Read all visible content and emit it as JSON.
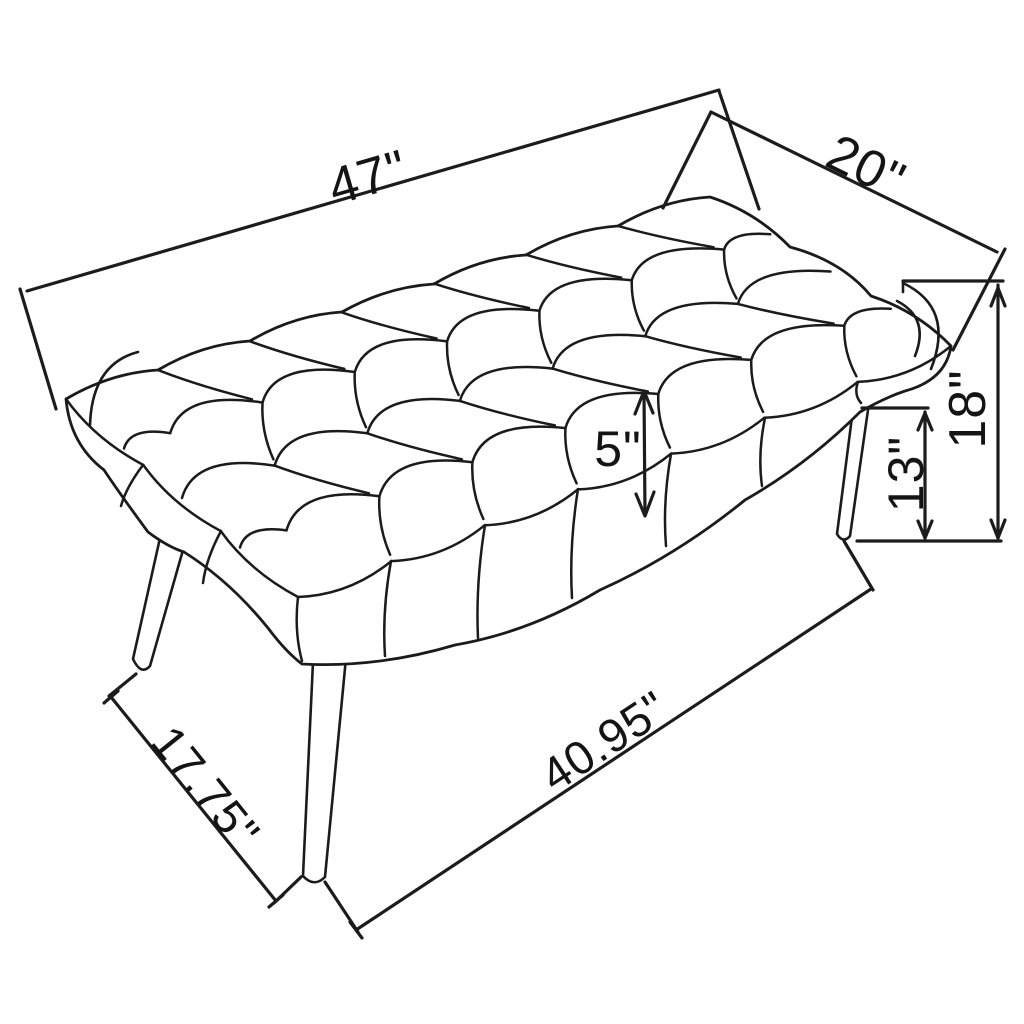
{
  "figure": {
    "name": "tufted-bench-dimension-drawing",
    "style": "black line art on white"
  },
  "colors": {
    "line": "#1b1b1b",
    "background": "#ffffff",
    "text": "#141414"
  },
  "dimensions": {
    "overall_length": "47\"",
    "overall_depth": "20\"",
    "overall_height": "18\"",
    "leg_height": "13\"",
    "seat_thickness": "5\"",
    "leg_span_length": "40.95\"",
    "leg_span_depth": "17.75\""
  }
}
